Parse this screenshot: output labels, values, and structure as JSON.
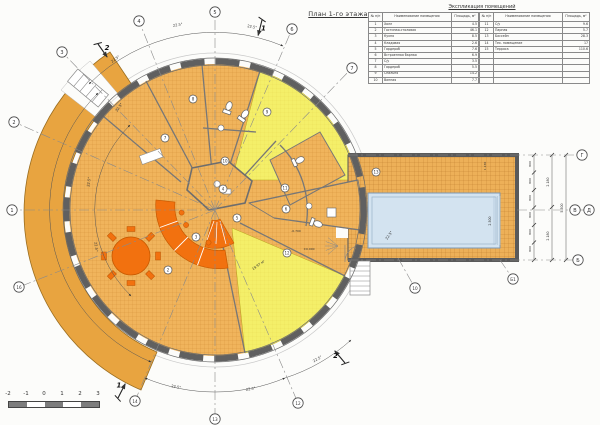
{
  "title": "План 1-го этажа",
  "schedule": {
    "caption": "Экспликация помещений",
    "col_headers": {
      "num": "№ п/п",
      "name": "Наименование помещения",
      "area": "Площадь, м²"
    },
    "left_rows": [
      {
        "num": "1",
        "name": "Холл",
        "area": "4.5"
      },
      {
        "num": "2",
        "name": "Гостиная-столовая",
        "area": "46.1"
      },
      {
        "num": "3",
        "name": "Кухня",
        "area": "8.5"
      },
      {
        "num": "4",
        "name": "Кладовая",
        "area": "2.6"
      },
      {
        "num": "5",
        "name": "Гардероб",
        "area": "7.6"
      },
      {
        "num": "6",
        "name": "Встроенная барная",
        "area": "6.9"
      },
      {
        "num": "7",
        "name": "С/у",
        "area": "3.5"
      },
      {
        "num": "8",
        "name": "Гардероб",
        "area": "5.5"
      },
      {
        "num": "9",
        "name": "Спальня",
        "area": "14.2"
      },
      {
        "num": "10",
        "name": "Ванная",
        "area": "7.7"
      }
    ],
    "right_rows": [
      {
        "num": "11",
        "name": "С/у",
        "area": "9.6"
      },
      {
        "num": "12",
        "name": "Парная",
        "area": "5.7"
      },
      {
        "num": "13",
        "name": "Бассейн",
        "area": "28.3"
      },
      {
        "num": "14",
        "name": "Тех. помещение",
        "area": "17"
      },
      {
        "num": "15",
        "name": "Терраса",
        "area": "110.6"
      }
    ],
    "empty_right_rows": 5
  },
  "scale_bar": {
    "labels": [
      "-2",
      "-1",
      "0",
      "1",
      "2",
      "3"
    ]
  },
  "colors": {
    "room_orange": "#f0b45c",
    "terrace_orange": "#e8a440",
    "yellow": "#f4ef69",
    "accent_orange": "#f2710f",
    "pool_blue": "#d3e3f0",
    "wall_gray": "#5f5f5f",
    "line": "#4a4a4a"
  },
  "plan": {
    "axis_bubbles": [
      {
        "label": "1",
        "x": 12,
        "y": 210
      },
      {
        "label": "2",
        "x": 14,
        "y": 122
      },
      {
        "label": "3",
        "x": 62,
        "y": 52
      },
      {
        "label": "4",
        "x": 139,
        "y": 21
      },
      {
        "label": "5",
        "x": 215,
        "y": 12
      },
      {
        "label": "6",
        "x": 292,
        "y": 29
      },
      {
        "label": "7",
        "x": 352,
        "y": 68
      },
      {
        "label": "10",
        "x": 415,
        "y": 288,
        "lx": 398,
        "ly": 258
      },
      {
        "label": "12",
        "x": 298,
        "y": 403
      },
      {
        "label": "13",
        "x": 215,
        "y": 419
      },
      {
        "label": "14",
        "x": 135,
        "y": 401
      },
      {
        "label": "16",
        "x": 19,
        "y": 287
      },
      {
        "label": "Г",
        "x": 582,
        "y": 155,
        "lx": 348,
        "ly": 155
      },
      {
        "label": "В",
        "x": 575,
        "y": 210,
        "lx": 517,
        "ly": 210
      },
      {
        "label": "Д",
        "x": 589,
        "y": 210,
        "lx": 580,
        "ly": 210
      },
      {
        "label": "Б",
        "x": 578,
        "y": 260,
        "lx": 348,
        "ly": 260
      },
      {
        "label": "Б1",
        "x": 513,
        "y": 279,
        "lx": 500,
        "ly": 260
      }
    ],
    "room_numbers": [
      {
        "n": "2",
        "x": 168,
        "y": 270
      },
      {
        "n": "3",
        "x": 196,
        "y": 237
      },
      {
        "n": "4",
        "x": 223,
        "y": 189
      },
      {
        "n": "5",
        "x": 237,
        "y": 218
      },
      {
        "n": "6",
        "x": 286,
        "y": 209
      },
      {
        "n": "7",
        "x": 165,
        "y": 138
      },
      {
        "n": "8",
        "x": 193,
        "y": 99
      },
      {
        "n": "9",
        "x": 267,
        "y": 112
      },
      {
        "n": "10",
        "x": 225,
        "y": 161
      },
      {
        "n": "11",
        "x": 285,
        "y": 188
      },
      {
        "n": "12",
        "x": 287,
        "y": 253
      },
      {
        "n": "13",
        "x": 376,
        "y": 172
      }
    ],
    "section_marks": [
      {
        "label": "1",
        "x": 262,
        "y": 20,
        "rot": 104
      },
      {
        "label": "2",
        "x": 98,
        "y": 44,
        "rot": 55
      },
      {
        "label": "1",
        "x": 118,
        "y": 398,
        "rot": -63
      },
      {
        "label": "2",
        "x": 345,
        "y": 363,
        "rot": -130
      }
    ],
    "labels": [
      {
        "t": "22.5°",
        "x": 178,
        "y": 26,
        "r": -10
      },
      {
        "t": "22.5°",
        "x": 252,
        "y": 28,
        "r": 10
      },
      {
        "t": "22.5°",
        "x": 116,
        "y": 60,
        "r": -35
      },
      {
        "t": "22.5°",
        "x": 120,
        "y": 108,
        "r": -55
      },
      {
        "t": "22.5°",
        "x": 90,
        "y": 182,
        "r": -83
      },
      {
        "t": "22.5°",
        "x": 95,
        "y": 247,
        "r": 83
      },
      {
        "t": "22.5°",
        "x": 176,
        "y": 388,
        "r": 10
      },
      {
        "t": "22.5°",
        "x": 251,
        "y": 390,
        "r": -10
      },
      {
        "t": "22.5°",
        "x": 318,
        "y": 360,
        "r": -30
      },
      {
        "t": "22.5°",
        "x": 390,
        "y": 236,
        "r": -55
      },
      {
        "t": "800",
        "x": 531,
        "y": 164,
        "r": -90,
        "s": 3
      },
      {
        "t": "800",
        "x": 531,
        "y": 181,
        "r": -90,
        "s": 3
      },
      {
        "t": "800",
        "x": 531,
        "y": 198,
        "r": -90,
        "s": 3
      },
      {
        "t": "800",
        "x": 531,
        "y": 215,
        "r": -90,
        "s": 3
      },
      {
        "t": "800",
        "x": 531,
        "y": 232,
        "r": -90,
        "s": 3
      },
      {
        "t": "800",
        "x": 531,
        "y": 249,
        "r": -90,
        "s": 3
      },
      {
        "t": "2.180",
        "x": 549,
        "y": 182,
        "r": -90,
        "s": 3.2
      },
      {
        "t": "2.180",
        "x": 549,
        "y": 236,
        "r": -90,
        "s": 3.2
      },
      {
        "t": "5.500",
        "x": 563,
        "y": 208,
        "r": -90,
        "s": 3.2
      },
      {
        "t": "2.500",
        "x": 491,
        "y": 221,
        "r": -90,
        "s": 3.2
      },
      {
        "t": "1.130",
        "x": 486,
        "y": 166,
        "r": -90,
        "s": 3
      },
      {
        "t": "19.97 м²",
        "x": 259,
        "y": 266,
        "r": -35,
        "s": 3.4
      },
      {
        "t": "-0.700",
        "x": 296,
        "y": 232,
        "r": 0,
        "s": 3
      },
      {
        "t": "±0.000",
        "x": 309,
        "y": 250,
        "r": 0,
        "s": 3
      }
    ]
  }
}
